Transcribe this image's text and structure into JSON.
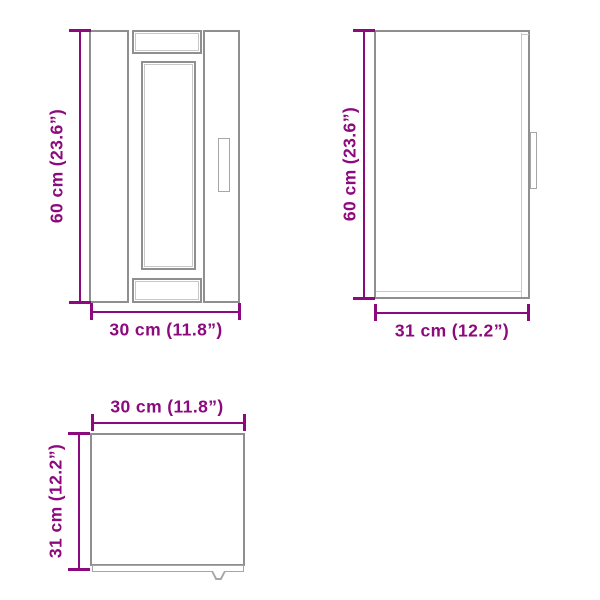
{
  "views": {
    "front": {
      "height_label": "60 cm (23.6”)",
      "width_label": "30 cm (11.8”)"
    },
    "side": {
      "height_label": "60 cm (23.6”)",
      "depth_label": "31 cm (12.2”)"
    },
    "top": {
      "width_label": "30 cm (11.8”)",
      "depth_label": "31 cm (12.2”)"
    }
  },
  "colors": {
    "dimension": "#8C0A7D",
    "outline": "#8F8F8F",
    "outline_mid": "#A6A6A6",
    "outline_light": "#C8C8C8",
    "background": "#FFFFFF"
  }
}
